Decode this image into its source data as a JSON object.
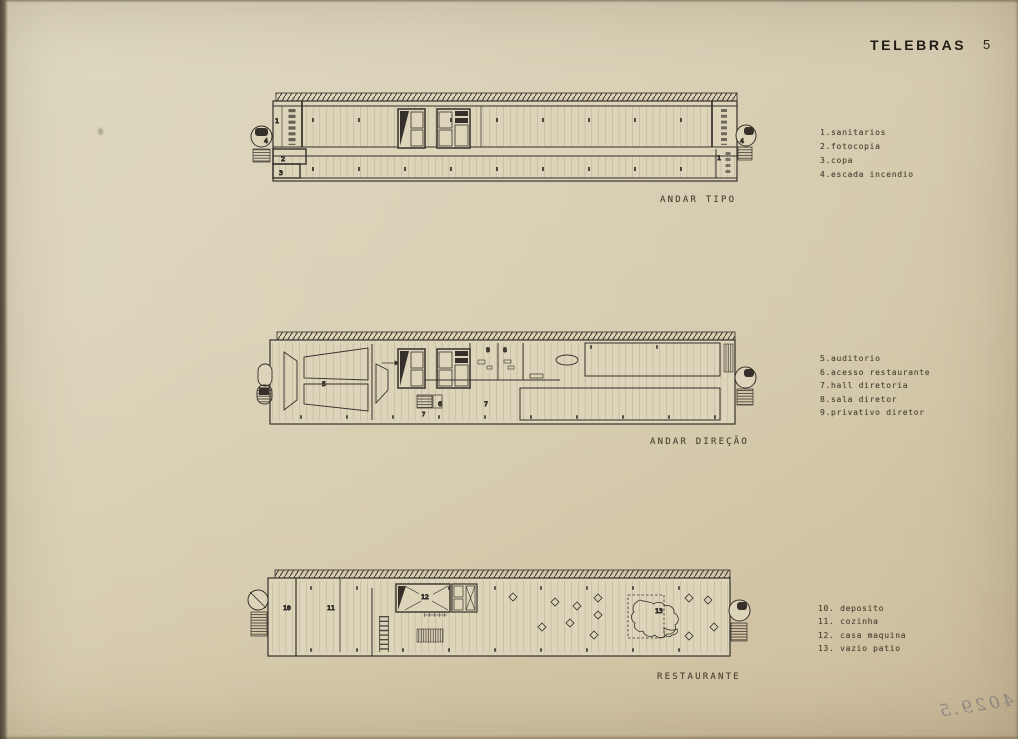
{
  "header": {
    "title": "TELEBRAS",
    "page_number": "5"
  },
  "plans": [
    {
      "name": "ANDAR TIPO",
      "legend": [
        "1.sanitarios",
        "2.fotocopia",
        "3.copa",
        "4.escada incendio"
      ],
      "rooms": [
        "1",
        "4",
        "2",
        "3",
        "1",
        "4"
      ]
    },
    {
      "name": "ANDAR DIREÇÃO",
      "legend": [
        "5.auditorio",
        "6.acesso restaurante",
        "7.hall diretoria",
        "8.sala diretor",
        "9.privativo diretor"
      ],
      "rooms": [
        "5",
        "9",
        "8",
        "6",
        "7",
        "7"
      ]
    },
    {
      "name": "RESTAURANTE",
      "legend": [
        "10. deposito",
        "11. cozinha",
        "12. casa maquina",
        "13. vazio patio"
      ],
      "rooms": [
        "10",
        "11",
        "12",
        "13"
      ]
    }
  ],
  "annotations": {
    "handwritten_number": "4029.5"
  },
  "colors": {
    "paper": "#dad2b7",
    "ink": "#35302a",
    "caption_ink": "#4a4334"
  }
}
